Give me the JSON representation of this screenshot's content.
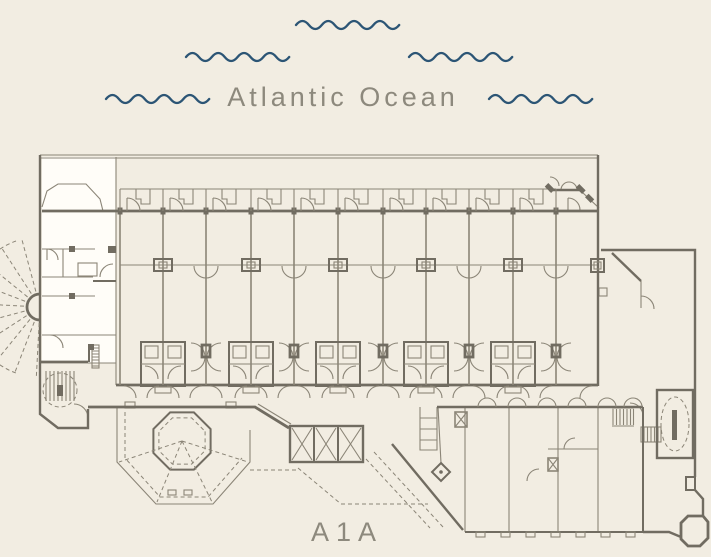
{
  "theme": {
    "background": "#f2ede2",
    "line": "#8b8577",
    "wall": "#716c61",
    "highlight_fill": "#fffdf8",
    "wave_color": "#2c5575",
    "text_color": "#8d897d"
  },
  "ocean": {
    "label": "Atlantic Ocean",
    "waves": [
      {
        "x": 296,
        "y": 20
      },
      {
        "x": 186,
        "y": 52
      },
      {
        "x": 409,
        "y": 52
      },
      {
        "x": 106,
        "y": 94
      },
      {
        "x": 489,
        "y": 94
      }
    ]
  },
  "road": {
    "label": "A1A"
  },
  "plan": {
    "highlighted_unit": {
      "x": 42,
      "y": 157,
      "width": 74,
      "height": 206
    },
    "dividers": [
      {
        "x": 120,
        "kind": "plain"
      },
      {
        "x": 163,
        "kind": "pod"
      },
      {
        "x": 206,
        "kind": "door"
      },
      {
        "x": 251,
        "kind": "pod"
      },
      {
        "x": 294,
        "kind": "door"
      },
      {
        "x": 338,
        "kind": "pod"
      },
      {
        "x": 383,
        "kind": "door"
      },
      {
        "x": 426,
        "kind": "pod"
      },
      {
        "x": 469,
        "kind": "door"
      },
      {
        "x": 513,
        "kind": "pod"
      },
      {
        "x": 556,
        "kind": "door"
      }
    ],
    "right_wall_x": 598,
    "lobby_arches_x": [
      487,
      517,
      547,
      577,
      607,
      633
    ],
    "lobby_ticks_x": [
      476,
      501,
      526,
      551,
      576,
      601,
      626
    ],
    "elevators": [
      {
        "x": 292,
        "w": 20
      },
      {
        "x": 316,
        "w": 20
      },
      {
        "x": 340,
        "w": 21
      }
    ]
  }
}
